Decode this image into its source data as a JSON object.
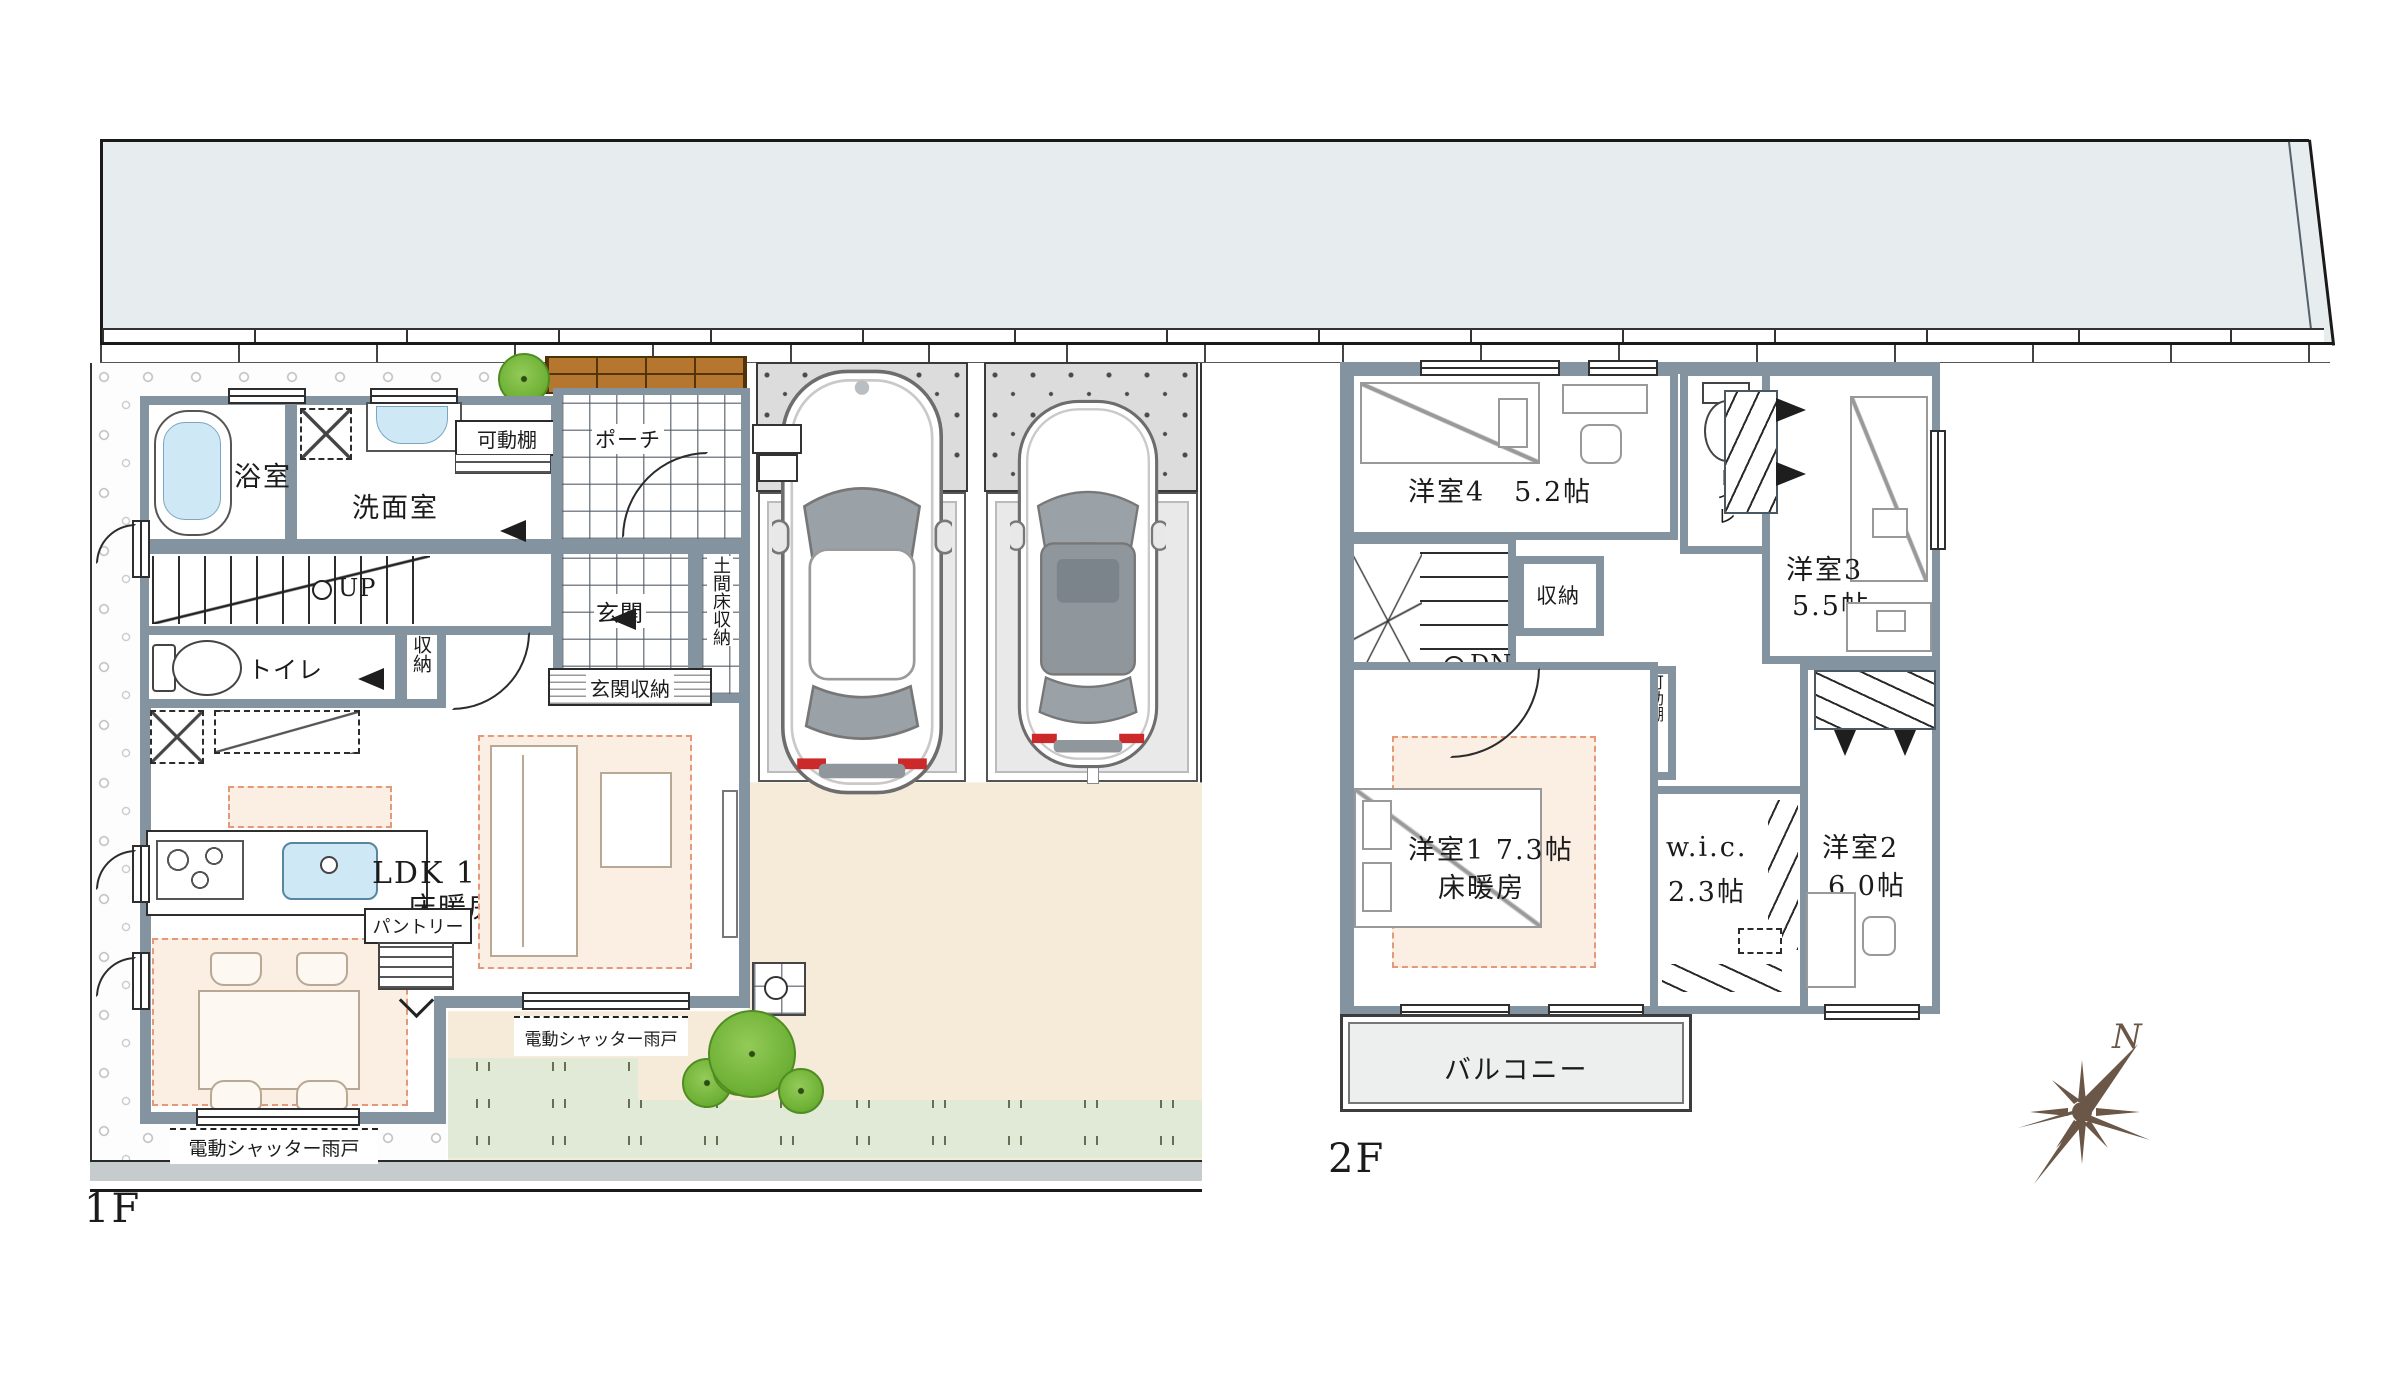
{
  "colors": {
    "wall": "#8493a0",
    "road": "#e7ecef",
    "driveway": "#f6ead9",
    "lawn": "#e0ead6",
    "floor_heat": "#fbeee3",
    "water": "#cfe8f5",
    "deck": "#b5762f",
    "tree": "#6fb136",
    "compass": "#6b5747"
  },
  "floor1": {
    "label": "1F",
    "bath": "浴室",
    "washroom": "洗面室",
    "movable_shelf": "可動棚",
    "porch": "ポーチ",
    "up": "UP",
    "toilet": "トイレ",
    "closet": "収納",
    "genkan": "玄関",
    "genkan_storage": "玄関収納",
    "doma_storage": "土間床収納",
    "pantry": "パントリー",
    "ldk": "LDK 18.7帖",
    "floor_heating": "床暖房",
    "shutter": "電動シャッター雨戸"
  },
  "floor2": {
    "label": "2F",
    "room4": "洋室4　5.2帖",
    "toilet": "トイレ",
    "closet": "収納",
    "down": "DN",
    "room3_name": "洋室3",
    "room3_size": "5.5帖",
    "movable_shelf": "可動棚",
    "room1_name": "洋室1  7.3帖",
    "room1_heating": "床暖房",
    "wic_name": "w.i.c.",
    "wic_size": "2.3帖",
    "room2_name": "洋室2",
    "room2_size": "6.0帖",
    "balcony": "バルコニー"
  },
  "compass": {
    "north": "N"
  }
}
